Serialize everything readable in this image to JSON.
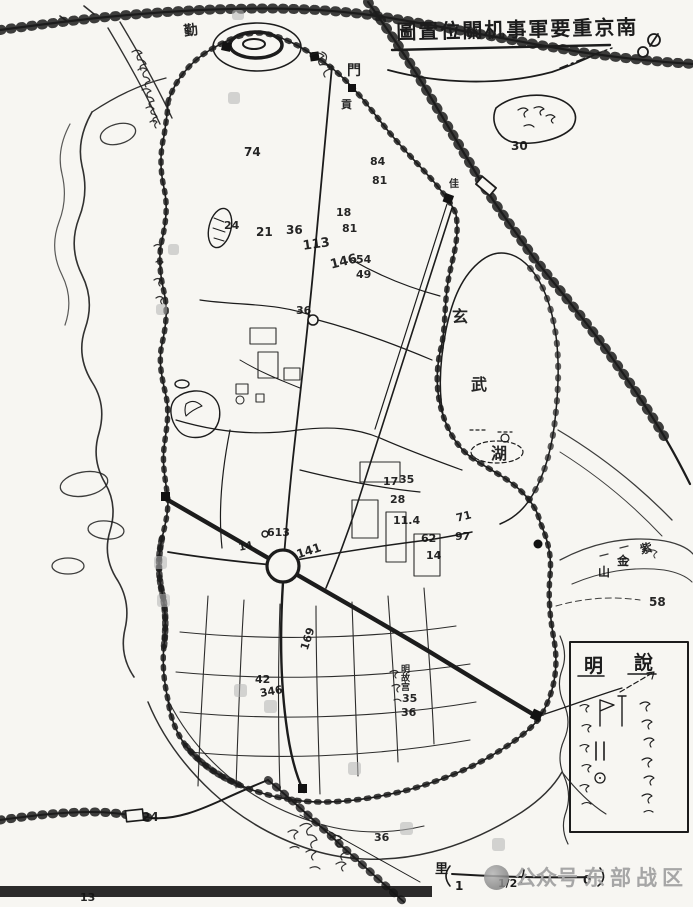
{
  "canvas": {
    "bg": "#f7f6f2",
    "ink": "#1c1c1c"
  },
  "title": {
    "text": "圖置位關机事軍要重京南"
  },
  "legend": {
    "char_right": "說",
    "char_left": "明"
  },
  "scale_bar": {
    "unit": "里",
    "tick_labels": [
      "1",
      "1/2",
      "0"
    ]
  },
  "watermark": {
    "prefix": "公众号",
    "name": "东部战区",
    "color": "#a6a6a6"
  },
  "lake": {
    "name_chars": [
      "玄",
      "武",
      "湖"
    ]
  },
  "mountain": {
    "name_chars": [
      "紫",
      "金",
      "山"
    ],
    "spot_height": "58"
  },
  "labels": [
    {
      "text": "74",
      "x": 244,
      "y": 146
    },
    {
      "text": "24",
      "x": 224,
      "y": 220,
      "size": 11
    },
    {
      "text": "21",
      "x": 256,
      "y": 226
    },
    {
      "text": "36",
      "x": 286,
      "y": 224
    },
    {
      "text": "113",
      "x": 302,
      "y": 240,
      "size": 13,
      "rot": -8
    },
    {
      "text": "18",
      "x": 336,
      "y": 207,
      "size": 11
    },
    {
      "text": "81",
      "x": 342,
      "y": 223,
      "size": 11
    },
    {
      "text": "146",
      "x": 329,
      "y": 259,
      "size": 13,
      "rot": -14
    },
    {
      "text": "54",
      "x": 356,
      "y": 254,
      "size": 11
    },
    {
      "text": "49",
      "x": 356,
      "y": 269,
      "size": 11
    },
    {
      "text": "84",
      "x": 370,
      "y": 156,
      "size": 11
    },
    {
      "text": "81",
      "x": 372,
      "y": 175,
      "size": 11
    },
    {
      "text": "佳",
      "x": 449,
      "y": 180,
      "size": 10
    },
    {
      "text": "36",
      "x": 296,
      "y": 305,
      "size": 11
    },
    {
      "text": "30",
      "x": 511,
      "y": 140
    },
    {
      "text": "14",
      "x": 238,
      "y": 544,
      "size": 10,
      "rot": -12
    },
    {
      "text": "613",
      "x": 267,
      "y": 527,
      "size": 11
    },
    {
      "text": "141",
      "x": 295,
      "y": 549,
      "size": 12,
      "rot": -18
    },
    {
      "text": "17",
      "x": 383,
      "y": 476,
      "size": 11
    },
    {
      "text": "35",
      "x": 399,
      "y": 474,
      "size": 11
    },
    {
      "text": "28",
      "x": 390,
      "y": 494,
      "size": 11
    },
    {
      "text": "11.4",
      "x": 393,
      "y": 515,
      "size": 11
    },
    {
      "text": "62",
      "x": 421,
      "y": 533,
      "size": 11
    },
    {
      "text": "14",
      "x": 426,
      "y": 550,
      "size": 11
    },
    {
      "text": "71",
      "x": 455,
      "y": 513,
      "size": 11,
      "rot": -14
    },
    {
      "text": "97",
      "x": 455,
      "y": 531,
      "size": 11
    },
    {
      "text": "169",
      "x": 299,
      "y": 648,
      "size": 11,
      "rot": -72
    },
    {
      "text": "42",
      "x": 255,
      "y": 674,
      "size": 11
    },
    {
      "text": "346",
      "x": 259,
      "y": 688,
      "size": 11,
      "rot": -10
    },
    {
      "text": "35",
      "x": 402,
      "y": 693,
      "size": 11
    },
    {
      "text": "36",
      "x": 401,
      "y": 707,
      "size": 11
    },
    {
      "text": "58",
      "x": 649,
      "y": 596
    },
    {
      "text": "24",
      "x": 142,
      "y": 811
    },
    {
      "text": "36",
      "x": 374,
      "y": 832,
      "size": 11
    },
    {
      "text": "13",
      "x": 80,
      "y": 892,
      "size": 11
    },
    {
      "text": "門",
      "x": 347,
      "y": 64,
      "size": 14
    },
    {
      "text": "貢",
      "x": 341,
      "y": 99,
      "size": 11
    },
    {
      "text": "勤",
      "x": 183,
      "y": 25,
      "size": 14,
      "rot": -8
    },
    {
      "text": "玄",
      "x": 452,
      "y": 309,
      "size": 16
    },
    {
      "text": "武",
      "x": 471,
      "y": 377,
      "size": 16
    },
    {
      "text": "湖",
      "x": 491,
      "y": 446,
      "size": 16
    },
    {
      "text": "紫",
      "x": 639,
      "y": 544,
      "size": 12,
      "rot": -12
    },
    {
      "text": "金",
      "x": 617,
      "y": 555,
      "size": 12
    },
    {
      "text": "山",
      "x": 598,
      "y": 566,
      "size": 12
    },
    {
      "text": "明故宫",
      "x": 399,
      "y": 664,
      "size": 9,
      "vertical": true
    }
  ]
}
